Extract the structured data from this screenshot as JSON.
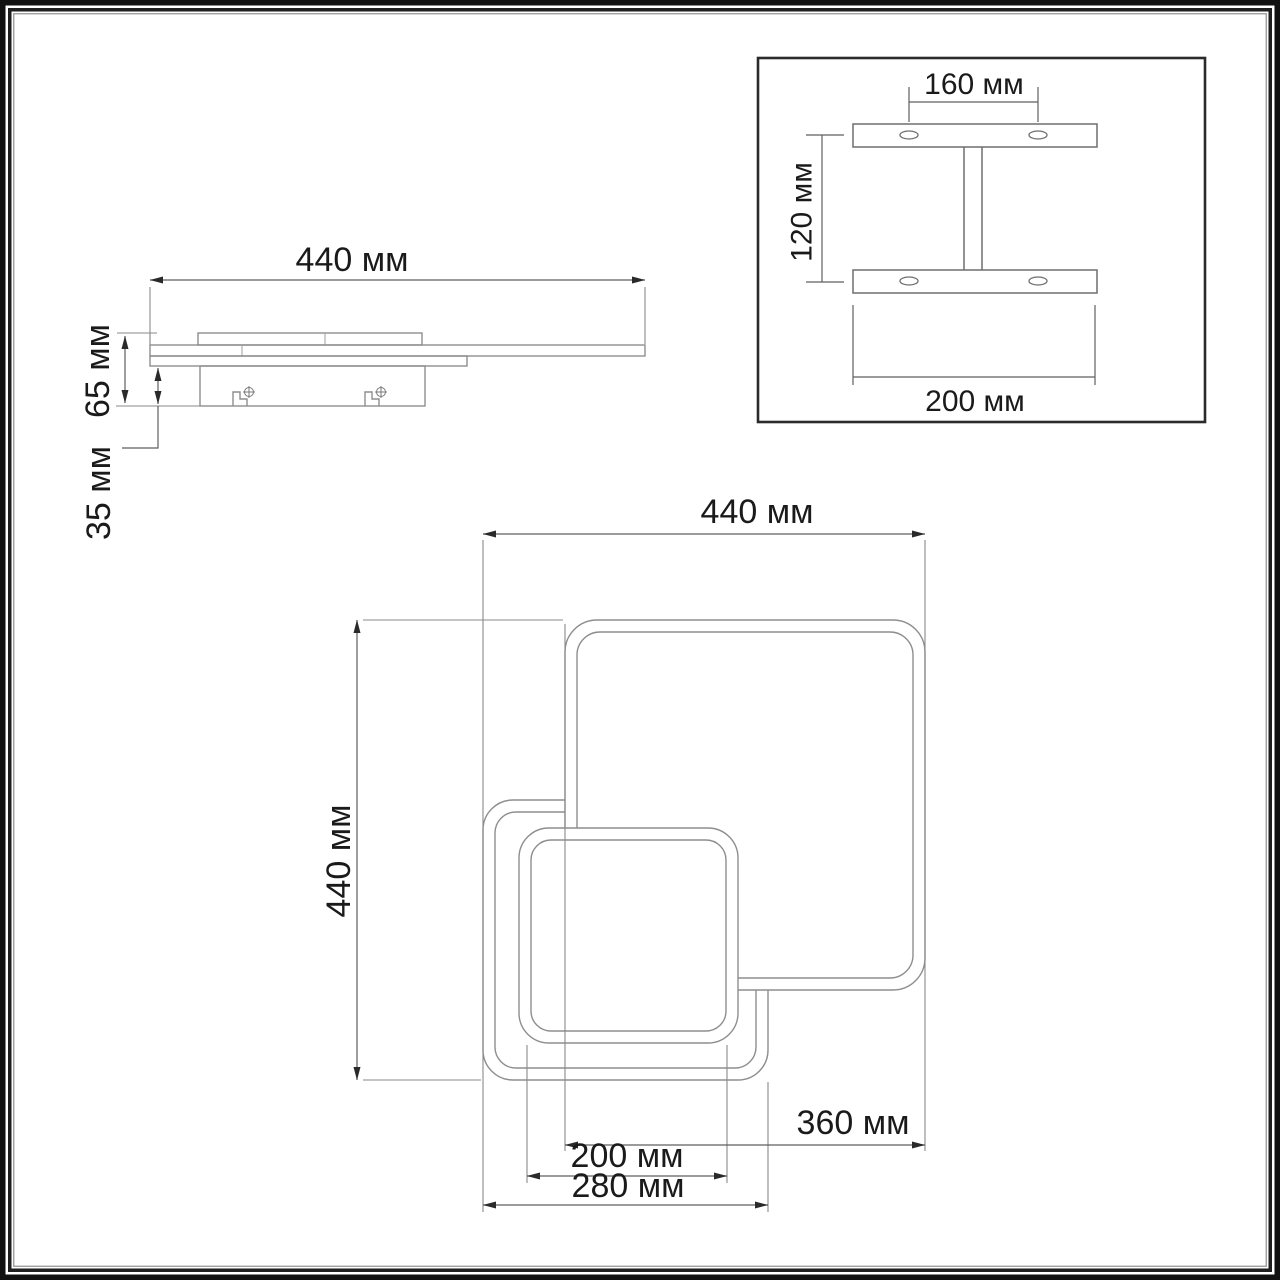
{
  "sheet": {
    "background": "#ffffff",
    "frame_color": "#101010",
    "outline_color": "#8e8e8e",
    "dimension_line_color": "#5f5f5f",
    "text_color": "#1a1a1a",
    "detail_box_border_color": "#2b2b2b",
    "units": "мм"
  },
  "side_view": {
    "width_label": "440 мм",
    "height_label": "65 мм",
    "base_height_label": "35 мм"
  },
  "bracket_detail": {
    "hole_spacing_label": "160 мм",
    "height_label": "120 мм",
    "width_label": "200 мм"
  },
  "plan_view": {
    "width_label": "440 мм",
    "height_label": "440 мм",
    "large_square_label": "360 мм",
    "small_square_label": "200 мм",
    "medium_square_label": "280 мм"
  },
  "dimensions_mm": {
    "overall_width": 440,
    "overall_height": 440,
    "fixture_depth": 65,
    "mounting_base_depth": 35,
    "bracket_hole_spacing": 160,
    "bracket_height": 120,
    "bracket_width": 200,
    "large_square": 360,
    "medium_square": 280,
    "small_square": 200
  }
}
